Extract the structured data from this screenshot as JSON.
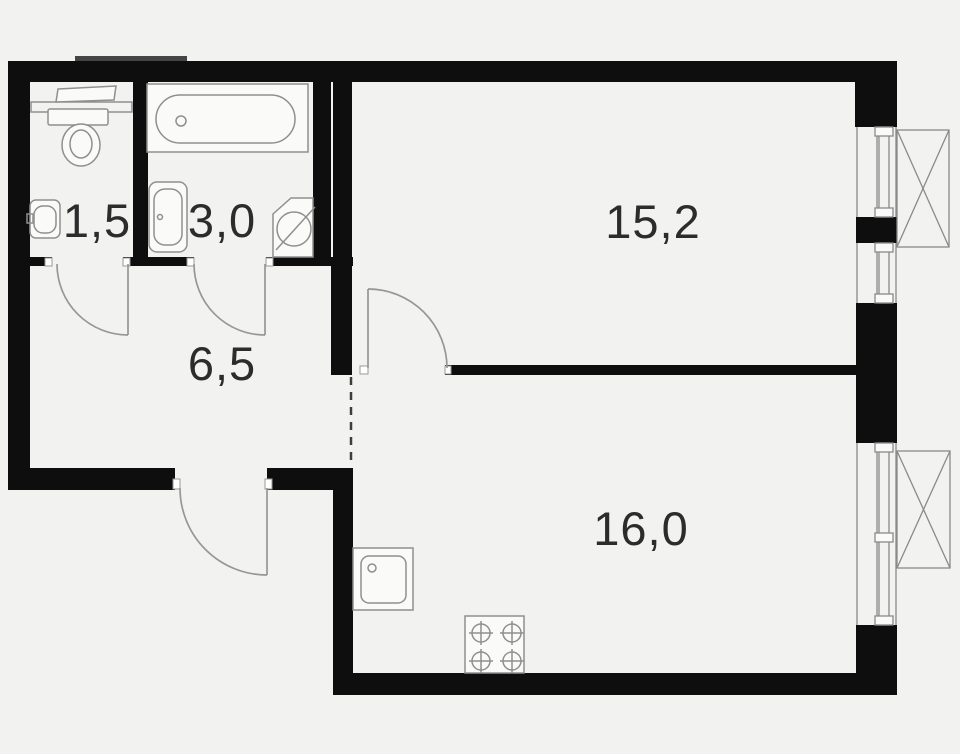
{
  "plan": {
    "type": "apartment-floor-plan",
    "rooms": [
      {
        "id": "wc",
        "area_label": "1,5"
      },
      {
        "id": "bathroom",
        "area_label": "3,0"
      },
      {
        "id": "hallway",
        "area_label": "6,5"
      },
      {
        "id": "living-room",
        "area_label": "15,2"
      },
      {
        "id": "kitchen-living",
        "area_label": "16,0"
      }
    ],
    "fixtures": [
      "toilet",
      "wc-sink",
      "wc-shelf",
      "bathtub",
      "bath-sink",
      "washing-machine",
      "kitchen-sink",
      "stove-4-burner"
    ],
    "openings": {
      "doors": [
        "wc-door",
        "bathroom-door",
        "bedroom-door",
        "entrance-door"
      ],
      "windows": [
        "bedroom-window-large",
        "bedroom-window-small",
        "kitchen-window"
      ],
      "ac_baskets": 2,
      "virtual_boundary": "hallway-kitchen-dashed-line"
    }
  },
  "colors": {
    "background": "#f2f2f0",
    "wall": "#0e0e0e",
    "fixture_line": "#8f8f8f",
    "fixture_fill": "#fafaf9",
    "door_line": "#979797",
    "window_line": "#8a8a8a",
    "dashed_line": "#3e3e3e",
    "label_text": "#2c2c2c",
    "vent_block": "#454545"
  }
}
